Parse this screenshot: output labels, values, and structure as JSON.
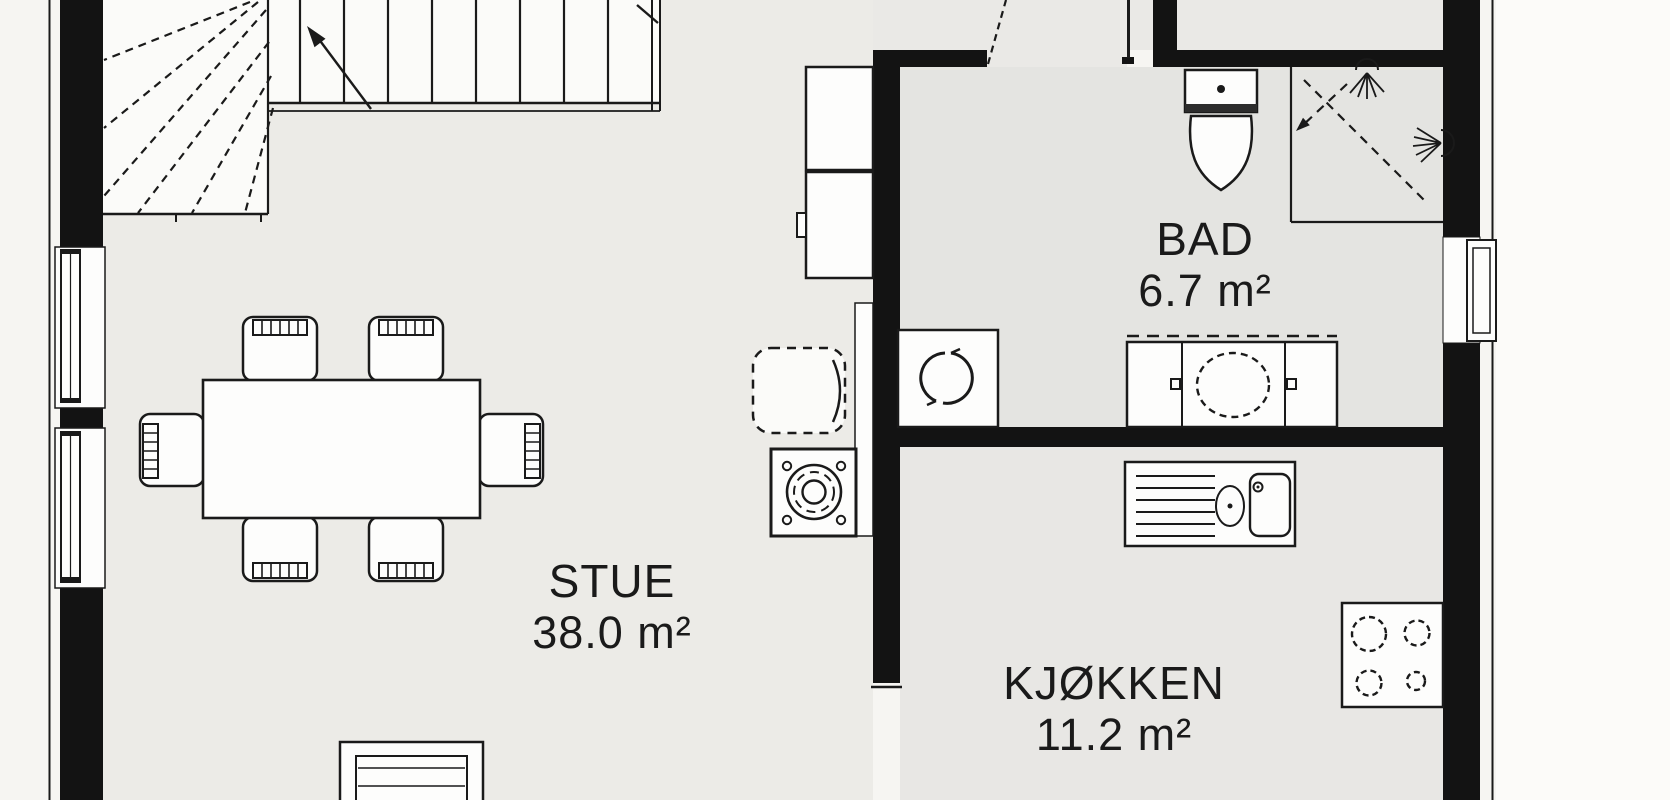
{
  "plan_title": "floor-plan",
  "rooms": {
    "stue": {
      "name": "STUE",
      "area": "38.0 m²"
    },
    "kjokken": {
      "name": "KJØKKEN",
      "area": "11.2 m²"
    },
    "bad": {
      "name": "BAD",
      "area": "6.7 m²"
    }
  },
  "fixtures": [
    "winder-staircase",
    "stair-direction-arrow",
    "dining-table",
    "dining-chairs",
    "armchair",
    "wood-stove",
    "chimney",
    "wall-cabinets",
    "washing-machine",
    "toilet",
    "shower-cabin",
    "shower-head",
    "vanity-basin",
    "kitchen-sink",
    "cooktop",
    "bench",
    "window",
    "door-opening"
  ],
  "colors": {
    "wall": "#131313",
    "ink": "#1a1a1a",
    "outside": "#f6f5f2",
    "paper": "#fcfbf9",
    "floor_stue": "#ecebe7",
    "floor_bad": "#e4e4e1",
    "floor_kitchen": "#e8e7e4",
    "floor_hall": "#eae9e6",
    "fixture": "#fdfdfc",
    "stair": "#fbfbf9"
  }
}
